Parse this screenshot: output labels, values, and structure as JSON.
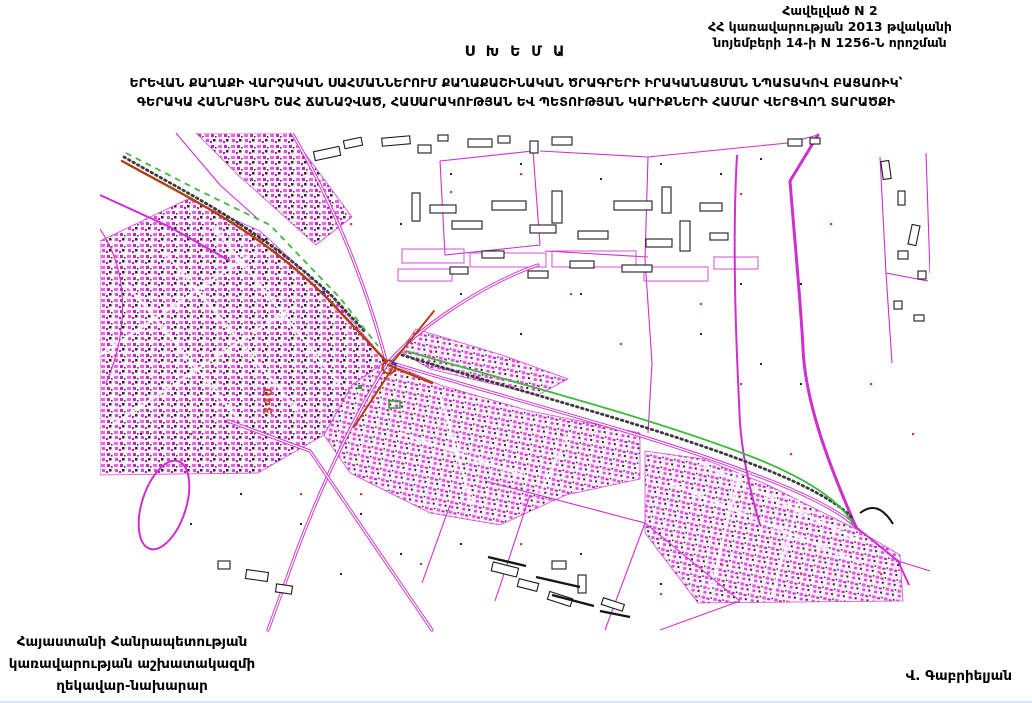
{
  "document": {
    "annex": {
      "line1": "Հավելված N 2",
      "line2": "ՀՀ կառավարության 2013 թվականի",
      "line3": "նոյեմբերի 14-ի N 1256-Ն որոշման"
    },
    "title": "Ս Խ Ե Մ Ա",
    "subtitle": {
      "line1": "ԵՐԵՎԱՆ ՔԱՂԱՔԻ ՎԱՐՉԱԿԱՆ ՍԱՀՄԱՆՆԵՐՈՒՄ ՔԱՂԱՔԱՇԻՆԱԿԱՆ ԾՐԱԳՐԵՐԻ ԻՐԱԿԱՆԱՑՄԱՆ ՆՊԱՏԱԿՈՎ ԲԱՑԱՌԻԿ՝",
      "line2": "ԳԵՐԱԿԱ ՀԱՆՐԱՅԻՆ ՇԱՀ ՃԱՆԱՉՎԱԾ, ՀԱՍԱՐԱԿՈՒԹՅԱՆ ԵՎ ՊԵՏՈՒԹՅԱՆ ԿԱՐԻՔՆԵՐԻ ՀԱՄԱՐ ՎԵՐՑՎՈՂ ՏԱՐԱԾՔԻ"
    },
    "map": {
      "parcel_label": "340",
      "colors": {
        "parcel_line": "#cf2fcf",
        "building_outline": "#1c1c1c",
        "route_red": "#b2400f",
        "route_green": "#3db93d",
        "label_red": "#cf4040"
      }
    },
    "signature": {
      "left": {
        "line1": "Հայաստանի Հանրապետության",
        "line2": "կառավարության աշխատակազմի",
        "line3": "ղեկավար-նախարար"
      },
      "right": "Վ. Գաբրիելյան"
    }
  }
}
